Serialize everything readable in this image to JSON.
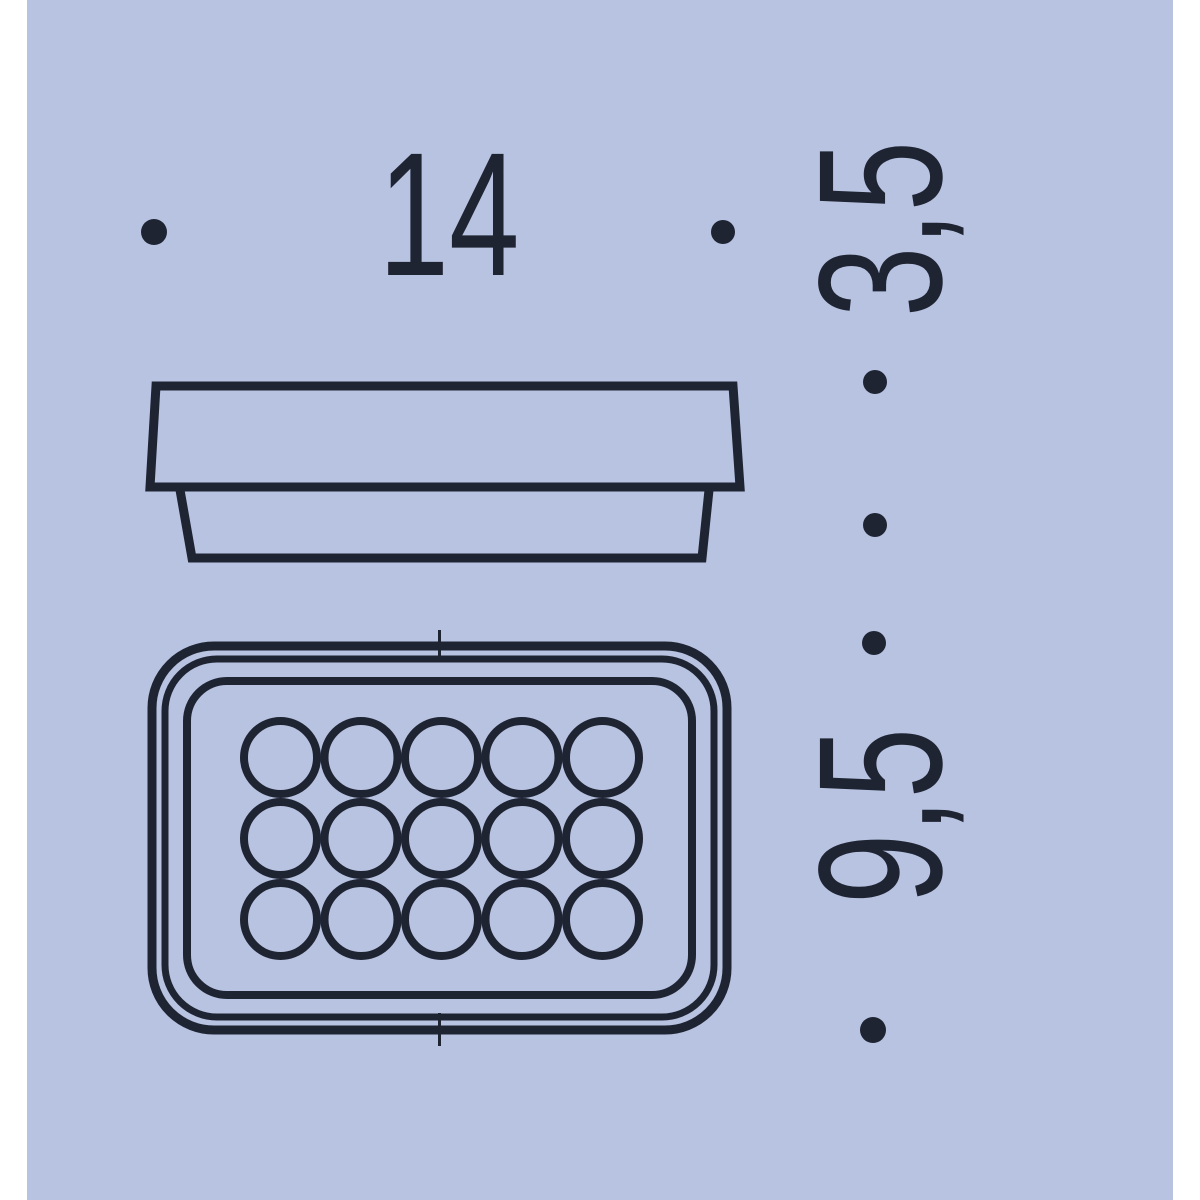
{
  "colors": {
    "page_margin": "#ffffff",
    "background": "#b7c3e1",
    "line": "#1f2433"
  },
  "dimensions": {
    "width": {
      "label": "14",
      "orientation": "horizontal"
    },
    "side_height": {
      "label": "3,5",
      "orientation": "vertical"
    },
    "depth": {
      "label": "9,5",
      "orientation": "vertical"
    }
  },
  "top_view": {
    "hole_rows": 3,
    "hole_cols": 5,
    "hole_count": 15
  }
}
